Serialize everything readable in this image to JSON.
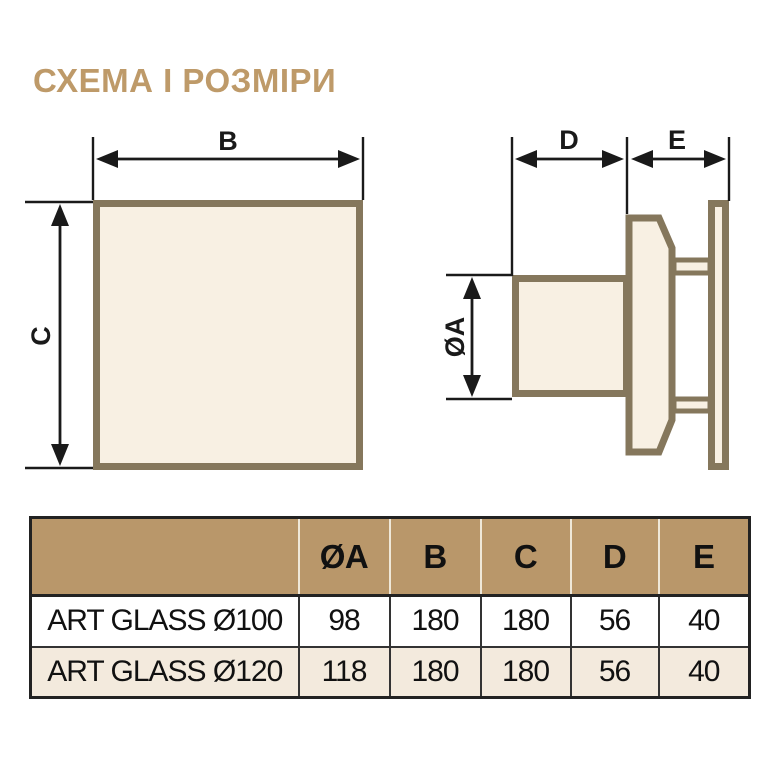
{
  "title": "СХЕМА І РОЗМІРИ",
  "diagram": {
    "front_view": {
      "width_label": "B",
      "height_label": "C"
    },
    "side_view": {
      "depth_label": "D",
      "panel_gap_label": "E",
      "diameter_label": "ØA"
    }
  },
  "table": {
    "headers": [
      "ØA",
      "B",
      "C",
      "D",
      "E"
    ],
    "rows": [
      {
        "model": "ART GLASS Ø100",
        "values": [
          "98",
          "180",
          "180",
          "56",
          "40"
        ]
      },
      {
        "model": "ART GLASS Ø120",
        "values": [
          "118",
          "180",
          "180",
          "56",
          "40"
        ]
      }
    ]
  },
  "colors": {
    "accent": "#BE9A69",
    "table_header_bg": "#B9976A",
    "table_alt_row_bg": "#F3EADD",
    "diagram_fill": "#F8F0E3",
    "diagram_outline": "#85775C",
    "dimension_line": "#1A1A1A"
  }
}
